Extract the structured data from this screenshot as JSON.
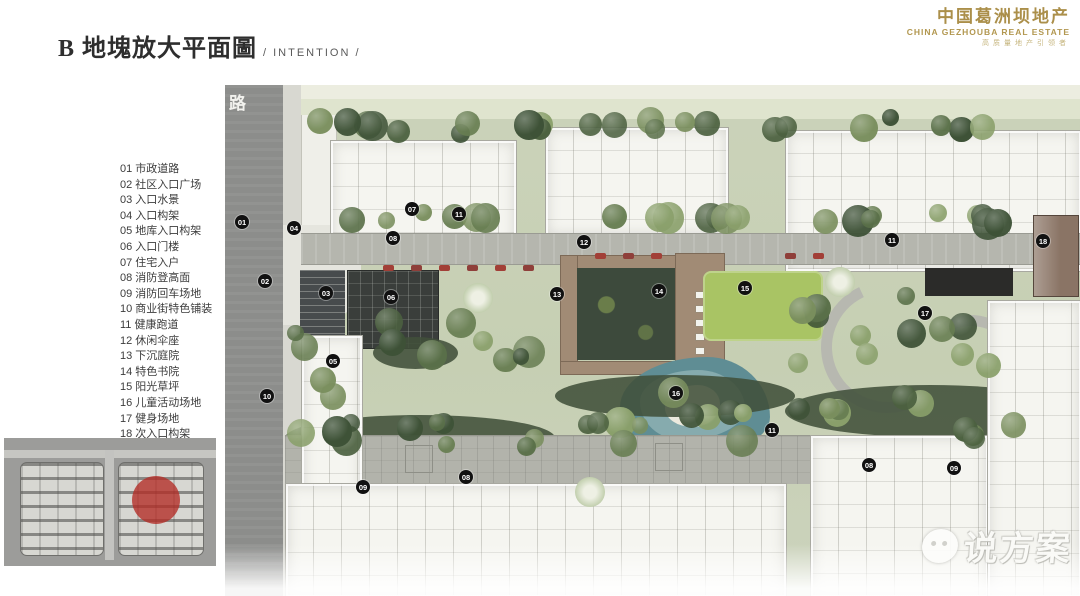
{
  "header": {
    "title_zh": "B 地塊放大平面圖",
    "title_en": "/ INTENTION /"
  },
  "logo": {
    "line1": "中国葛洲坝地产",
    "line2": "CHINA GEZHOUBA REAL ESTATE",
    "line3": "高质量地产引领者"
  },
  "legend": {
    "items": [
      {
        "num": "01",
        "label": "市政道路"
      },
      {
        "num": "02",
        "label": "社区入口广场"
      },
      {
        "num": "03",
        "label": "入口水景"
      },
      {
        "num": "04",
        "label": "入口构架"
      },
      {
        "num": "05",
        "label": "地库入口构架"
      },
      {
        "num": "06",
        "label": "入口门楼"
      },
      {
        "num": "07",
        "label": "住宅入户"
      },
      {
        "num": "08",
        "label": "消防登高面"
      },
      {
        "num": "09",
        "label": "消防回车场地"
      },
      {
        "num": "10",
        "label": "商业街特色铺装"
      },
      {
        "num": "11",
        "label": "健康跑道"
      },
      {
        "num": "12",
        "label": "休闲伞座"
      },
      {
        "num": "13",
        "label": "下沉庭院"
      },
      {
        "num": "14",
        "label": "特色书院"
      },
      {
        "num": "15",
        "label": "阳光草坪"
      },
      {
        "num": "16",
        "label": "儿童活动场地"
      },
      {
        "num": "17",
        "label": "健身场地"
      },
      {
        "num": "18",
        "label": "次入口构架"
      }
    ]
  },
  "plan": {
    "road_label": "路",
    "markers": [
      {
        "n": "01",
        "x": 17,
        "y": 137
      },
      {
        "n": "02",
        "x": 40,
        "y": 196
      },
      {
        "n": "03",
        "x": 101,
        "y": 208
      },
      {
        "n": "04",
        "x": 69,
        "y": 143
      },
      {
        "n": "05",
        "x": 108,
        "y": 276
      },
      {
        "n": "06",
        "x": 166,
        "y": 212
      },
      {
        "n": "07",
        "x": 187,
        "y": 124
      },
      {
        "n": "08",
        "x": 168,
        "y": 153
      },
      {
        "n": "08",
        "x": 241,
        "y": 392
      },
      {
        "n": "08",
        "x": 644,
        "y": 380
      },
      {
        "n": "09",
        "x": 138,
        "y": 402
      },
      {
        "n": "09",
        "x": 729,
        "y": 383
      },
      {
        "n": "10",
        "x": 42,
        "y": 311
      },
      {
        "n": "11",
        "x": 234,
        "y": 129
      },
      {
        "n": "11",
        "x": 547,
        "y": 345
      },
      {
        "n": "11",
        "x": 667,
        "y": 155
      },
      {
        "n": "12",
        "x": 359,
        "y": 157
      },
      {
        "n": "13",
        "x": 332,
        "y": 209
      },
      {
        "n": "14",
        "x": 434,
        "y": 206
      },
      {
        "n": "15",
        "x": 520,
        "y": 203
      },
      {
        "n": "16",
        "x": 451,
        "y": 308
      },
      {
        "n": "17",
        "x": 700,
        "y": 228
      },
      {
        "n": "18",
        "x": 818,
        "y": 156
      }
    ]
  },
  "watermark": {
    "text": "说方案"
  },
  "colors": {
    "logo_gold": "#ab8f4a",
    "marker_black": "#111111",
    "lawn_green": "#a9c464",
    "playground_teal": "#5f8d94",
    "minimap_highlight_red": "#b32b25"
  }
}
